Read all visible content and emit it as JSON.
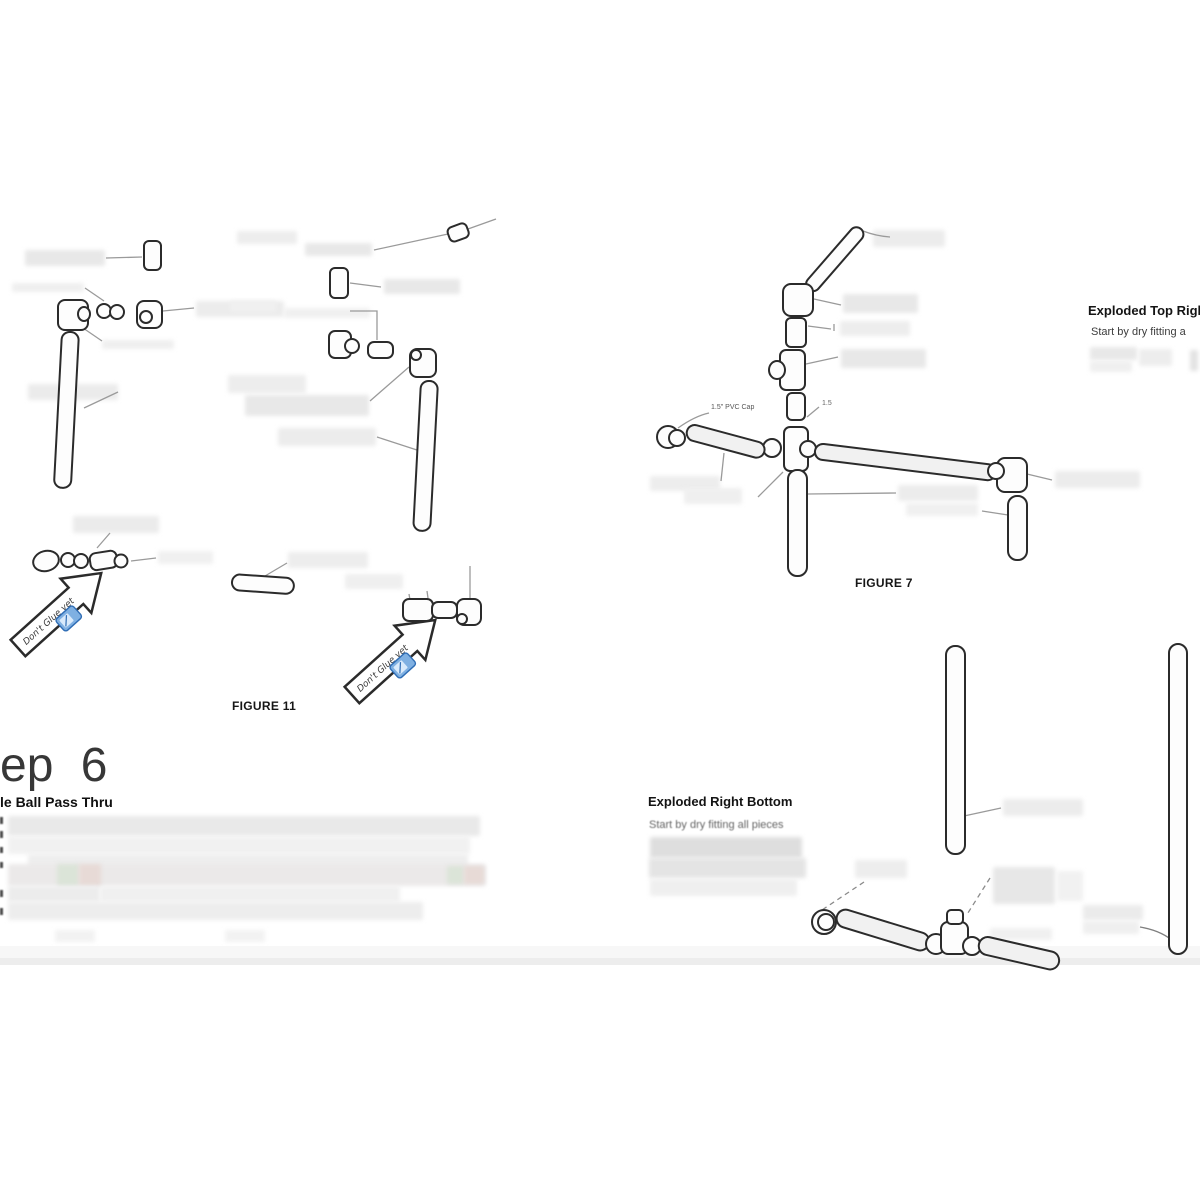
{
  "document": {
    "background_color": "#ffffff",
    "section_step": {
      "heading_visible": "ep 6",
      "subheading_visible": "le Ball Pass Thru"
    },
    "figures": {
      "figure11_caption": "FIGURE 11",
      "figure7_caption": "FIGURE 7"
    },
    "exploded_top_right": {
      "heading": "Exploded Top Right",
      "intro_visible": "Start by dry fitting a"
    },
    "exploded_right_bottom": {
      "heading": "Exploded Right Bottom",
      "intro": "Start by dry fitting all pieces"
    },
    "callouts": {
      "pvc_cap": "1.5\" PVC Cap",
      "pipe_size_fragment": "1.5",
      "dont_glue": "Don't Glue yet"
    },
    "colors": {
      "line": "#2b2b2b",
      "leader": "#9a9a9a",
      "redaction": "#e8e8e8",
      "glue_icon_blue": "#7fb0e2",
      "glue_icon_border": "#2f6db5"
    }
  }
}
